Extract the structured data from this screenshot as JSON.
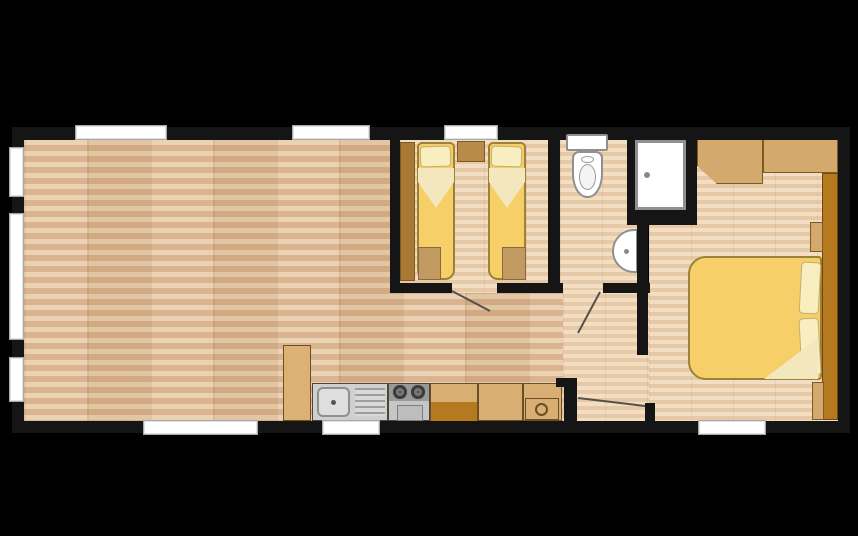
{
  "plan": {
    "type": "floorplan",
    "background_color": "#000000",
    "wall_color": "#151515",
    "window_color": "#ffffff",
    "door_swing_color": "#55514a",
    "counts": {
      "windows": 9,
      "internal_door_swings": 3
    },
    "rooms": {
      "living_kitchen": {
        "label": "Open-plan living area with kitchen",
        "floor_color": "#d8b08a"
      },
      "twin_bedroom": {
        "label": "Twin bedroom",
        "floor_color": "#e7c9a8"
      },
      "shower_room": {
        "label": "Shower room",
        "floor_color": "#e7c9a8"
      },
      "hallway": {
        "label": "Hallway",
        "floor_color": "#e7c9a8"
      },
      "master_bedroom": {
        "label": "Master bedroom",
        "floor_color": "#e7c9a8"
      }
    },
    "fixtures": {
      "twin_wardrobe": "Wardrobe",
      "twin_bed_1": "Single bed",
      "twin_bed_2": "Single bed",
      "bedside_cabinet": "Bedside cabinet",
      "toilet": "Toilet with cistern",
      "wash_basin": "Wash basin",
      "shower": "Shower cubicle",
      "overhead_locker_1": "Overhead locker",
      "overhead_locker_2": "Overhead locker",
      "master_wardrobe": "Wardrobe run",
      "double_bed": "Double bed",
      "tall_cabinet": "Tall kitchen cabinet",
      "sink_unit": "Sink with drainer",
      "cooker": "Two-burner cooker with oven",
      "base_cabinet": "Kitchen base cabinet",
      "worktop": "Kitchen worktop",
      "end_unit": "Kitchen end unit"
    },
    "palette": {
      "bed_yellow": "#f6cf68",
      "pillow_cream": "#f8eec0",
      "wood_dark": "#b5791f",
      "wood_mid": "#c0893d",
      "locker_tan": "#d3a96e",
      "counter_tan": "#d8ae72",
      "stainless": "#cfcfcf"
    }
  }
}
